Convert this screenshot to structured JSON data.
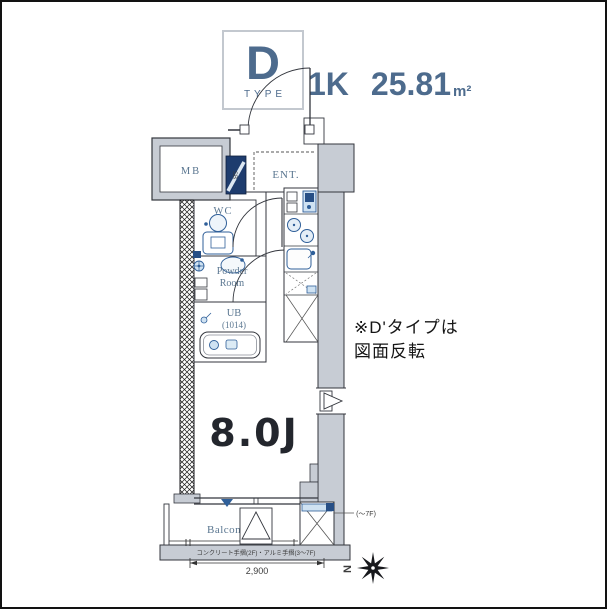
{
  "header": {
    "type_letter": "D",
    "type_caption": "TYPE",
    "layout": "1K",
    "area_value": "25.81",
    "area_unit": "m²"
  },
  "note": {
    "line1": "※D'タイプは",
    "line2": "図面反転"
  },
  "plan": {
    "labels": {
      "meter_box": "MB",
      "entrance": "ENT.",
      "shoe_box": "SB",
      "wc": "WC",
      "powder_line1": "Powder",
      "powder_line2": "Room",
      "bath": "UB",
      "bath_size": "(1014)",
      "main_room": "8.0J",
      "balcony": "Balcony"
    },
    "annotations": {
      "handrail": "コンクリート手摺(2F)・アルミ手摺(3〜7F)",
      "ac_floors": "(〜7F)",
      "width_dimension": "2,900",
      "compass_north": "N"
    },
    "colors": {
      "wall_fill": "#c7ccd4",
      "line": "#33363d",
      "label_slate": "#5a7690",
      "fixture_blue": "#2f5f99",
      "fixture_blue_light": "#cfe2f2",
      "shoe_box_navy": "#1e3c6e",
      "header_blue": "#4d6b8d"
    }
  }
}
